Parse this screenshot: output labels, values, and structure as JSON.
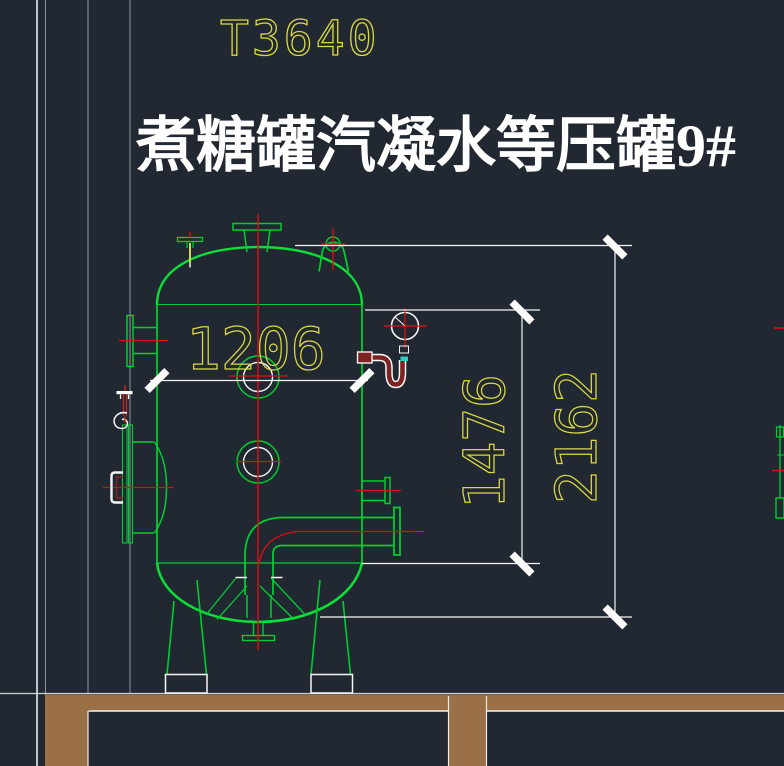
{
  "drawing": {
    "number": "T3640",
    "title": "煮糖罐汽凝水等压罐9#",
    "dimensions": {
      "diameter": "1206",
      "shell_height": "1476",
      "overall_height": "2162"
    },
    "colors": {
      "background": "#212831",
      "entity_green": "#00cd32",
      "centerline_red": "#dd1010",
      "dimension_yellow": "#d9d943",
      "dimension_white": "#f5f5f5",
      "construction_gray": "#8d96a0",
      "floor_brown": "#9c7046",
      "siphon_maroon": "#7e2222",
      "valve_cyan": "#35c8c8"
    }
  }
}
